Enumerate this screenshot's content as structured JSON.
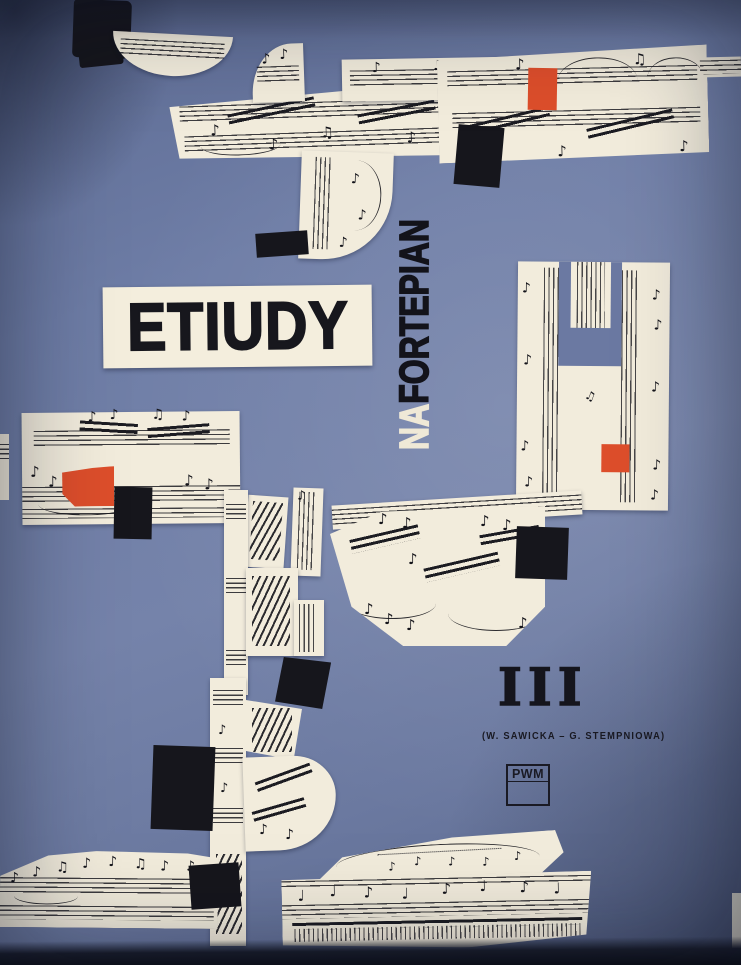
{
  "cover": {
    "title": "ETIUDY",
    "subtitle": {
      "prefix": "NA",
      "main": "FORTEPIAN"
    },
    "volume_numeral": "III",
    "authors_line": "(W. SAWICKA – G. STEMPNIOWA)",
    "publisher_logo": "PWM",
    "colors": {
      "background_blue": "#6e7da6",
      "paper_cream": "#f2ecdc",
      "accent_red": "#dd4e2b",
      "ink_black": "#16161c"
    }
  }
}
